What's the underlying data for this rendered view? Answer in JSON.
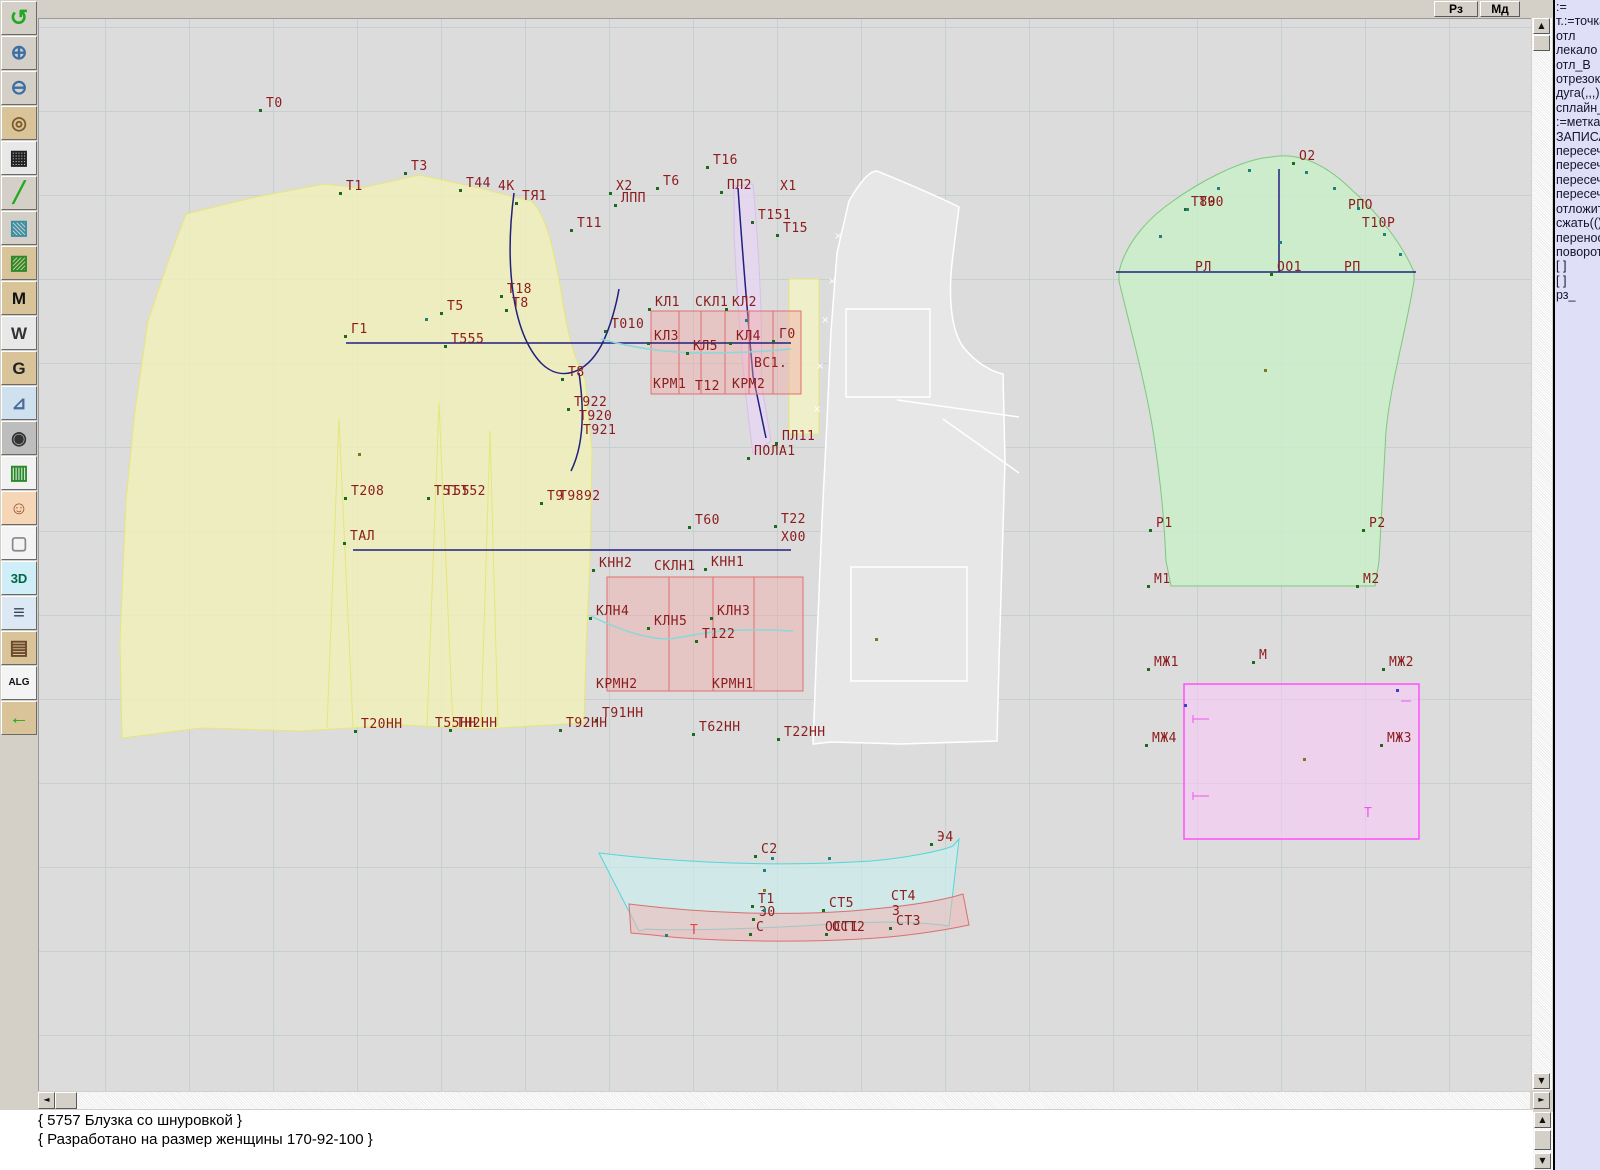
{
  "top_buttons": [
    {
      "name": "rz-button",
      "label": "Рз"
    },
    {
      "name": "md-button",
      "label": "Мд"
    }
  ],
  "toolbar": {
    "icons": [
      {
        "name": "undo-icon",
        "glyph": "↺",
        "fg": "#1faa1f",
        "bg": "#d4d0c8",
        "fs": 22
      },
      {
        "name": "zoom-in-icon",
        "glyph": "⊕",
        "fg": "#3a6ea5",
        "bg": "#d4d0c8",
        "fs": 20
      },
      {
        "name": "zoom-out-icon",
        "glyph": "⊖",
        "fg": "#3a6ea5",
        "bg": "#d4d0c8",
        "fs": 20
      },
      {
        "name": "piece-preview-icon",
        "glyph": "◎",
        "fg": "#7a5a2a",
        "bg": "#d9c49a",
        "fs": 18
      },
      {
        "name": "grid-icon",
        "glyph": "▦",
        "fg": "#222222",
        "bg": "#e8e8e8",
        "fs": 20
      },
      {
        "name": "segment-icon",
        "glyph": "╱",
        "fg": "#1faa1f",
        "bg": "#d4d0c8",
        "fs": 20
      },
      {
        "name": "image-icon",
        "glyph": "▧",
        "fg": "#3a8ea5",
        "bg": "#d4d0c8",
        "fs": 20
      },
      {
        "name": "piece-green-icon",
        "glyph": "▨",
        "fg": "#2a8a2a",
        "bg": "#d9c49a",
        "fs": 20
      },
      {
        "name": "piece-m-icon",
        "glyph": "M",
        "fg": "#111111",
        "bg": "#d9c49a",
        "fs": 17
      },
      {
        "name": "compass-w-icon",
        "glyph": "W",
        "fg": "#333333",
        "bg": "#e8e8e8",
        "fs": 17
      },
      {
        "name": "g-piece-icon",
        "glyph": "G",
        "fg": "#222222",
        "bg": "#d9c49a",
        "fs": 17
      },
      {
        "name": "ruler-icon",
        "glyph": "⊿",
        "fg": "#4a6a9a",
        "bg": "#cfe0ef",
        "fs": 18
      },
      {
        "name": "camera-icon",
        "glyph": "◉",
        "fg": "#333333",
        "bg": "#bdbdbd",
        "fs": 18
      },
      {
        "name": "table-icon",
        "glyph": "▥",
        "fg": "#2a8a2a",
        "bg": "#f2f2f2",
        "fs": 20
      },
      {
        "name": "photo-icon",
        "glyph": "☺",
        "fg": "#a0522d",
        "bg": "#f5d7b8",
        "fs": 18
      },
      {
        "name": "garment-sketch-icon",
        "glyph": "▢",
        "fg": "#888888",
        "bg": "#f4f4f4",
        "fs": 18
      },
      {
        "name": "threed-icon",
        "glyph": "3D",
        "fg": "#064",
        "bg": "#cfeef8",
        "fs": 13
      },
      {
        "name": "text-list-icon",
        "glyph": "≡",
        "fg": "#334455",
        "bg": "#dce8f4",
        "fs": 20
      },
      {
        "name": "books-icon",
        "glyph": "▤",
        "fg": "#6a4a2a",
        "bg": "#d9c49a",
        "fs": 20
      },
      {
        "name": "alg-icon",
        "glyph": "ALG",
        "fg": "#111111",
        "bg": "#f4f4f4",
        "fs": 10
      },
      {
        "name": "exit-icon",
        "glyph": "←",
        "fg": "#1faa1f",
        "bg": "#d9c49a",
        "fs": 20
      }
    ]
  },
  "panel": {
    "lines": [
      ":=",
      "т.:=точка",
      "отл",
      "лекало",
      "отл_В",
      "отрезок",
      "дуга(,,,)",
      "сплайн_",
      ":=метка",
      "ЗАПИСА",
      "пересеч",
      "пересеч",
      "пересеч",
      "пересеч",
      "отложит",
      "сжать(()",
      "перенос",
      "поворот",
      "[ ]",
      "[ ]",
      "рз_"
    ]
  },
  "status": {
    "line1": "{ 5757  Блузка со шнуровкой }",
    "line2": "{ Разработано на размер женщины 170-92-100 }"
  },
  "scroll": {
    "up": "▲",
    "down": "▼",
    "left": "◄",
    "right": "►"
  },
  "canvas": {
    "label_color": "#8b1c1c",
    "labels": [
      {
        "t": "Т0",
        "x": 265,
        "y": 95,
        "p": 1
      },
      {
        "t": "Т3",
        "x": 410,
        "y": 158,
        "p": 1
      },
      {
        "t": "Т1",
        "x": 345,
        "y": 178,
        "p": 1
      },
      {
        "t": "Т44",
        "x": 465,
        "y": 175,
        "p": 1
      },
      {
        "t": "4К",
        "x": 497,
        "y": 178
      },
      {
        "t": "ТЯ1",
        "x": 521,
        "y": 188,
        "p": 1
      },
      {
        "t": "Х2",
        "x": 615,
        "y": 178,
        "p": 1
      },
      {
        "t": "Т6",
        "x": 662,
        "y": 173,
        "p": 1
      },
      {
        "t": "Т16",
        "x": 712,
        "y": 152,
        "p": 1
      },
      {
        "t": "ПЛ2",
        "x": 726,
        "y": 177,
        "p": 1
      },
      {
        "t": "Х1",
        "x": 779,
        "y": 178
      },
      {
        "t": "ЛПП",
        "x": 620,
        "y": 190,
        "p": 1
      },
      {
        "t": "Т11",
        "x": 576,
        "y": 215,
        "p": 1
      },
      {
        "t": "Т151",
        "x": 757,
        "y": 207,
        "p": 1
      },
      {
        "t": "Т15",
        "x": 782,
        "y": 220,
        "p": 1
      },
      {
        "t": "Т18",
        "x": 506,
        "y": 281,
        "p": 1
      },
      {
        "t": "Т8",
        "x": 511,
        "y": 295,
        "p": 1
      },
      {
        "t": "Т5",
        "x": 446,
        "y": 298,
        "p": 1
      },
      {
        "t": "Г1",
        "x": 350,
        "y": 321,
        "p": 1
      },
      {
        "t": "Т555",
        "x": 450,
        "y": 331,
        "p": 1
      },
      {
        "t": "Т8",
        "x": 567,
        "y": 364,
        "p": 1
      },
      {
        "t": "КЛ1",
        "x": 654,
        "y": 294,
        "p": 1
      },
      {
        "t": "СКЛ1",
        "x": 694,
        "y": 294
      },
      {
        "t": "КЛ2",
        "x": 731,
        "y": 294,
        "p": 1
      },
      {
        "t": "Т010",
        "x": 610,
        "y": 316,
        "p": 1
      },
      {
        "t": "КЛ3",
        "x": 653,
        "y": 328,
        "p": 1
      },
      {
        "t": "КЛ5",
        "x": 692,
        "y": 338,
        "p": 1
      },
      {
        "t": "КЛ4",
        "x": 735,
        "y": 328,
        "p": 1
      },
      {
        "t": "Г0",
        "x": 778,
        "y": 326,
        "p": 1
      },
      {
        "t": "ВС1.",
        "x": 753,
        "y": 355
      },
      {
        "t": "КРМ1",
        "x": 652,
        "y": 376
      },
      {
        "t": "Т12",
        "x": 694,
        "y": 378
      },
      {
        "t": "КРМ2",
        "x": 731,
        "y": 376
      },
      {
        "t": "Т922",
        "x": 573,
        "y": 394,
        "p": 1
      },
      {
        "t": "Т920",
        "x": 578,
        "y": 408
      },
      {
        "t": "Т921",
        "x": 582,
        "y": 422
      },
      {
        "t": "ПЛ11",
        "x": 781,
        "y": 428,
        "p": 1
      },
      {
        "t": "ПОЛА1",
        "x": 753,
        "y": 443,
        "p": 1
      },
      {
        "t": "Т208",
        "x": 350,
        "y": 483,
        "p": 1
      },
      {
        "t": "Т51",
        "x": 433,
        "y": 483,
        "p": 1
      },
      {
        "t": "Т55",
        "x": 444,
        "y": 483
      },
      {
        "t": "Т52",
        "x": 460,
        "y": 483
      },
      {
        "t": "Т9",
        "x": 546,
        "y": 488,
        "p": 1
      },
      {
        "t": "Т9892",
        "x": 558,
        "y": 488
      },
      {
        "t": "Т60",
        "x": 694,
        "y": 512,
        "p": 1
      },
      {
        "t": "Т22",
        "x": 780,
        "y": 511,
        "p": 1
      },
      {
        "t": "ТАЛ",
        "x": 349,
        "y": 528,
        "p": 1
      },
      {
        "t": "Х00",
        "x": 780,
        "y": 529
      },
      {
        "t": "КНН2",
        "x": 598,
        "y": 555,
        "p": 1
      },
      {
        "t": "СКЛН1",
        "x": 653,
        "y": 558
      },
      {
        "t": "КНН1",
        "x": 710,
        "y": 554,
        "p": 1
      },
      {
        "t": "КЛН4",
        "x": 595,
        "y": 603,
        "p": 1
      },
      {
        "t": "КЛН5",
        "x": 653,
        "y": 613,
        "p": 1
      },
      {
        "t": "КЛН3",
        "x": 716,
        "y": 603,
        "p": 1
      },
      {
        "t": "Т122",
        "x": 701,
        "y": 626,
        "p": 1
      },
      {
        "t": "КРМН2",
        "x": 595,
        "y": 676
      },
      {
        "t": "КРМН1",
        "x": 711,
        "y": 676
      },
      {
        "t": "Т20НН",
        "x": 360,
        "y": 716,
        "p": 1
      },
      {
        "t": "Т55НН",
        "x": 434,
        "y": 715
      },
      {
        "t": "ТН2НН",
        "x": 455,
        "y": 715,
        "p": 1
      },
      {
        "t": "Т91НН",
        "x": 601,
        "y": 705,
        "p": 1
      },
      {
        "t": "Т92НН",
        "x": 565,
        "y": 715,
        "p": 1
      },
      {
        "t": "Т62НН",
        "x": 698,
        "y": 719,
        "p": 1
      },
      {
        "t": "Т22НН",
        "x": 783,
        "y": 724,
        "p": 1
      },
      {
        "t": "О2",
        "x": 1298,
        "y": 148,
        "p": 1
      },
      {
        "t": "Т80",
        "x": 1190,
        "y": 194,
        "p": 1
      },
      {
        "t": "Т90",
        "x": 1198,
        "y": 194
      },
      {
        "t": "РПО",
        "x": 1347,
        "y": 197
      },
      {
        "t": "Т10Р",
        "x": 1361,
        "y": 215
      },
      {
        "t": "РЛ",
        "x": 1194,
        "y": 259
      },
      {
        "t": "ОО1",
        "x": 1276,
        "y": 259,
        "p": 1
      },
      {
        "t": "РП",
        "x": 1343,
        "y": 259
      },
      {
        "t": "Р1",
        "x": 1155,
        "y": 515,
        "p": 1
      },
      {
        "t": "Р2",
        "x": 1368,
        "y": 515,
        "p": 1
      },
      {
        "t": "М1",
        "x": 1153,
        "y": 571,
        "p": 1
      },
      {
        "t": "М2",
        "x": 1362,
        "y": 571,
        "p": 1
      },
      {
        "t": "МЖ1",
        "x": 1153,
        "y": 654,
        "p": 1
      },
      {
        "t": "М",
        "x": 1258,
        "y": 647,
        "p": 1
      },
      {
        "t": "МЖ2",
        "x": 1388,
        "y": 654,
        "p": 1
      },
      {
        "t": "МЖ4",
        "x": 1151,
        "y": 730,
        "p": 1
      },
      {
        "t": "МЖ3",
        "x": 1386,
        "y": 730,
        "p": 1
      },
      {
        "t": "С2",
        "x": 760,
        "y": 841,
        "p": 1
      },
      {
        "t": "Э4",
        "x": 936,
        "y": 829,
        "p": 1
      },
      {
        "t": "Т1",
        "x": 757,
        "y": 891,
        "p": 1
      },
      {
        "t": "З0",
        "x": 758,
        "y": 904,
        "p": 1
      },
      {
        "t": "СТ5",
        "x": 828,
        "y": 895,
        "p": 1
      },
      {
        "t": "СТ4",
        "x": 890,
        "y": 888
      },
      {
        "t": "З",
        "x": 891,
        "y": 903
      },
      {
        "t": "СТ3",
        "x": 895,
        "y": 913,
        "p": 1
      },
      {
        "t": "С",
        "x": 755,
        "y": 919,
        "p": 1
      },
      {
        "t": "ОСТ1",
        "x": 824,
        "y": 919
      },
      {
        "t": "ОСТ2",
        "x": 831,
        "y": 919,
        "p": 1
      },
      {
        "t": "Т",
        "x": 689,
        "y": 922,
        "c": "#e04848"
      },
      {
        "t": "Т",
        "x": 1363,
        "y": 805,
        "c": "#ee55ee"
      }
    ],
    "xmarks": [
      [
        833,
        230
      ],
      [
        827,
        275
      ],
      [
        820,
        314
      ],
      [
        815,
        360
      ],
      [
        812,
        403
      ]
    ],
    "deco_points": [
      [
        1158,
        234,
        "#1f8080"
      ],
      [
        1185,
        207,
        "#1f8080"
      ],
      [
        1216,
        186,
        "#1f8080"
      ],
      [
        1247,
        168,
        "#1f8080"
      ],
      [
        1304,
        170,
        "#1f8080"
      ],
      [
        1332,
        186,
        "#1f8080"
      ],
      [
        1356,
        206,
        "#1f8080"
      ],
      [
        1382,
        232,
        "#1f8080"
      ],
      [
        1398,
        252,
        "#1f8080"
      ],
      [
        1278,
        240,
        "#1f8080"
      ],
      [
        1263,
        368,
        "#7a7a20"
      ],
      [
        1302,
        757,
        "#7a7a20"
      ],
      [
        1395,
        688,
        "#4040c0"
      ],
      [
        1183,
        703,
        "#4040c0"
      ],
      [
        770,
        856,
        "#1f8080"
      ],
      [
        827,
        856,
        "#1f8080"
      ],
      [
        762,
        868,
        "#1f8080"
      ],
      [
        762,
        888,
        "#7a7a20"
      ],
      [
        762,
        908,
        "#1f8080"
      ],
      [
        357,
        452,
        "#7a7a20"
      ],
      [
        424,
        317,
        "#1f8080"
      ],
      [
        744,
        318,
        "#1f8080"
      ],
      [
        874,
        637,
        "#7a7a20"
      ],
      [
        664,
        933,
        "#1f8080"
      ]
    ]
  }
}
